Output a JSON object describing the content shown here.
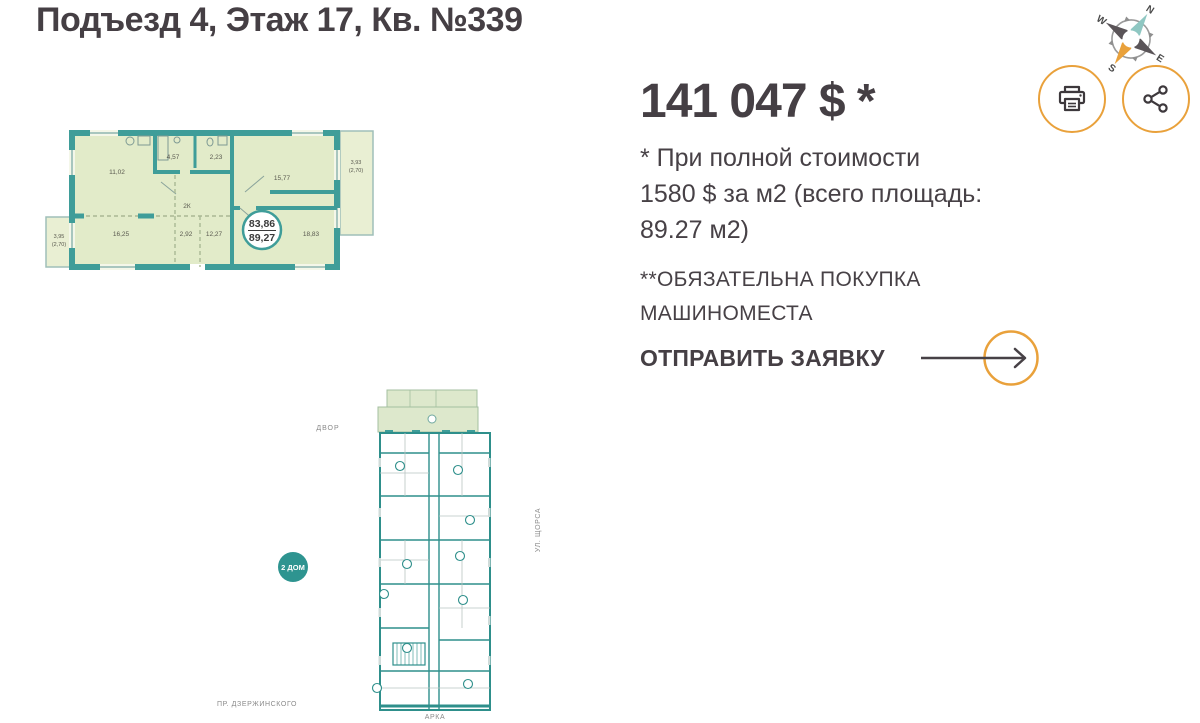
{
  "header": {
    "title": "Подъезд 4, Этаж 17, Кв. №339"
  },
  "compass": {
    "north": "N",
    "east": "E",
    "south": "S",
    "west": "W"
  },
  "offer": {
    "price": "141 047 $ *",
    "note_lines": [
      "* При полной стоимости",
      "1580 $ за м2 (всего площадь:",
      "89.27 м2)"
    ],
    "warning_lines": [
      "**ОБЯЗАТЕЛЬНА ПОКУПКА",
      "МАШИНОМЕСТА"
    ],
    "submit_label": "ОТПРАВИТЬ ЗАЯВКУ"
  },
  "apartment_plan": {
    "type_label": "2К",
    "living_area": "83,86",
    "total_area": "89,27",
    "rooms": {
      "kitchen_living": "11,02",
      "bathroom": "4,57",
      "wc": "2,23",
      "room_top_right": "15,77",
      "room_bottom_left": "16,25",
      "hall_small": "2,92",
      "hall": "12,27",
      "bedroom": "18,83"
    },
    "balcony_left": {
      "line1": "3,95",
      "line2": "(2,70)"
    },
    "balcony_right": {
      "line1": "3,93",
      "line2": "(2,70)"
    }
  },
  "site_plan": {
    "yard_label": "ДВОР",
    "street_right_label": "УЛ. ЩОРСА",
    "street_bottom_label": "ПР. ДЗЕРЖИНСКОГО",
    "arch_label": "АРКА",
    "house_badge": "2 ДОМ"
  },
  "colors": {
    "accent_orange": "#E9A13B",
    "wall_teal": "#3F9D99",
    "site_teal": "#2E8F8B",
    "plan_fill": "#E2EBC9",
    "dark_text": "#453F44"
  }
}
